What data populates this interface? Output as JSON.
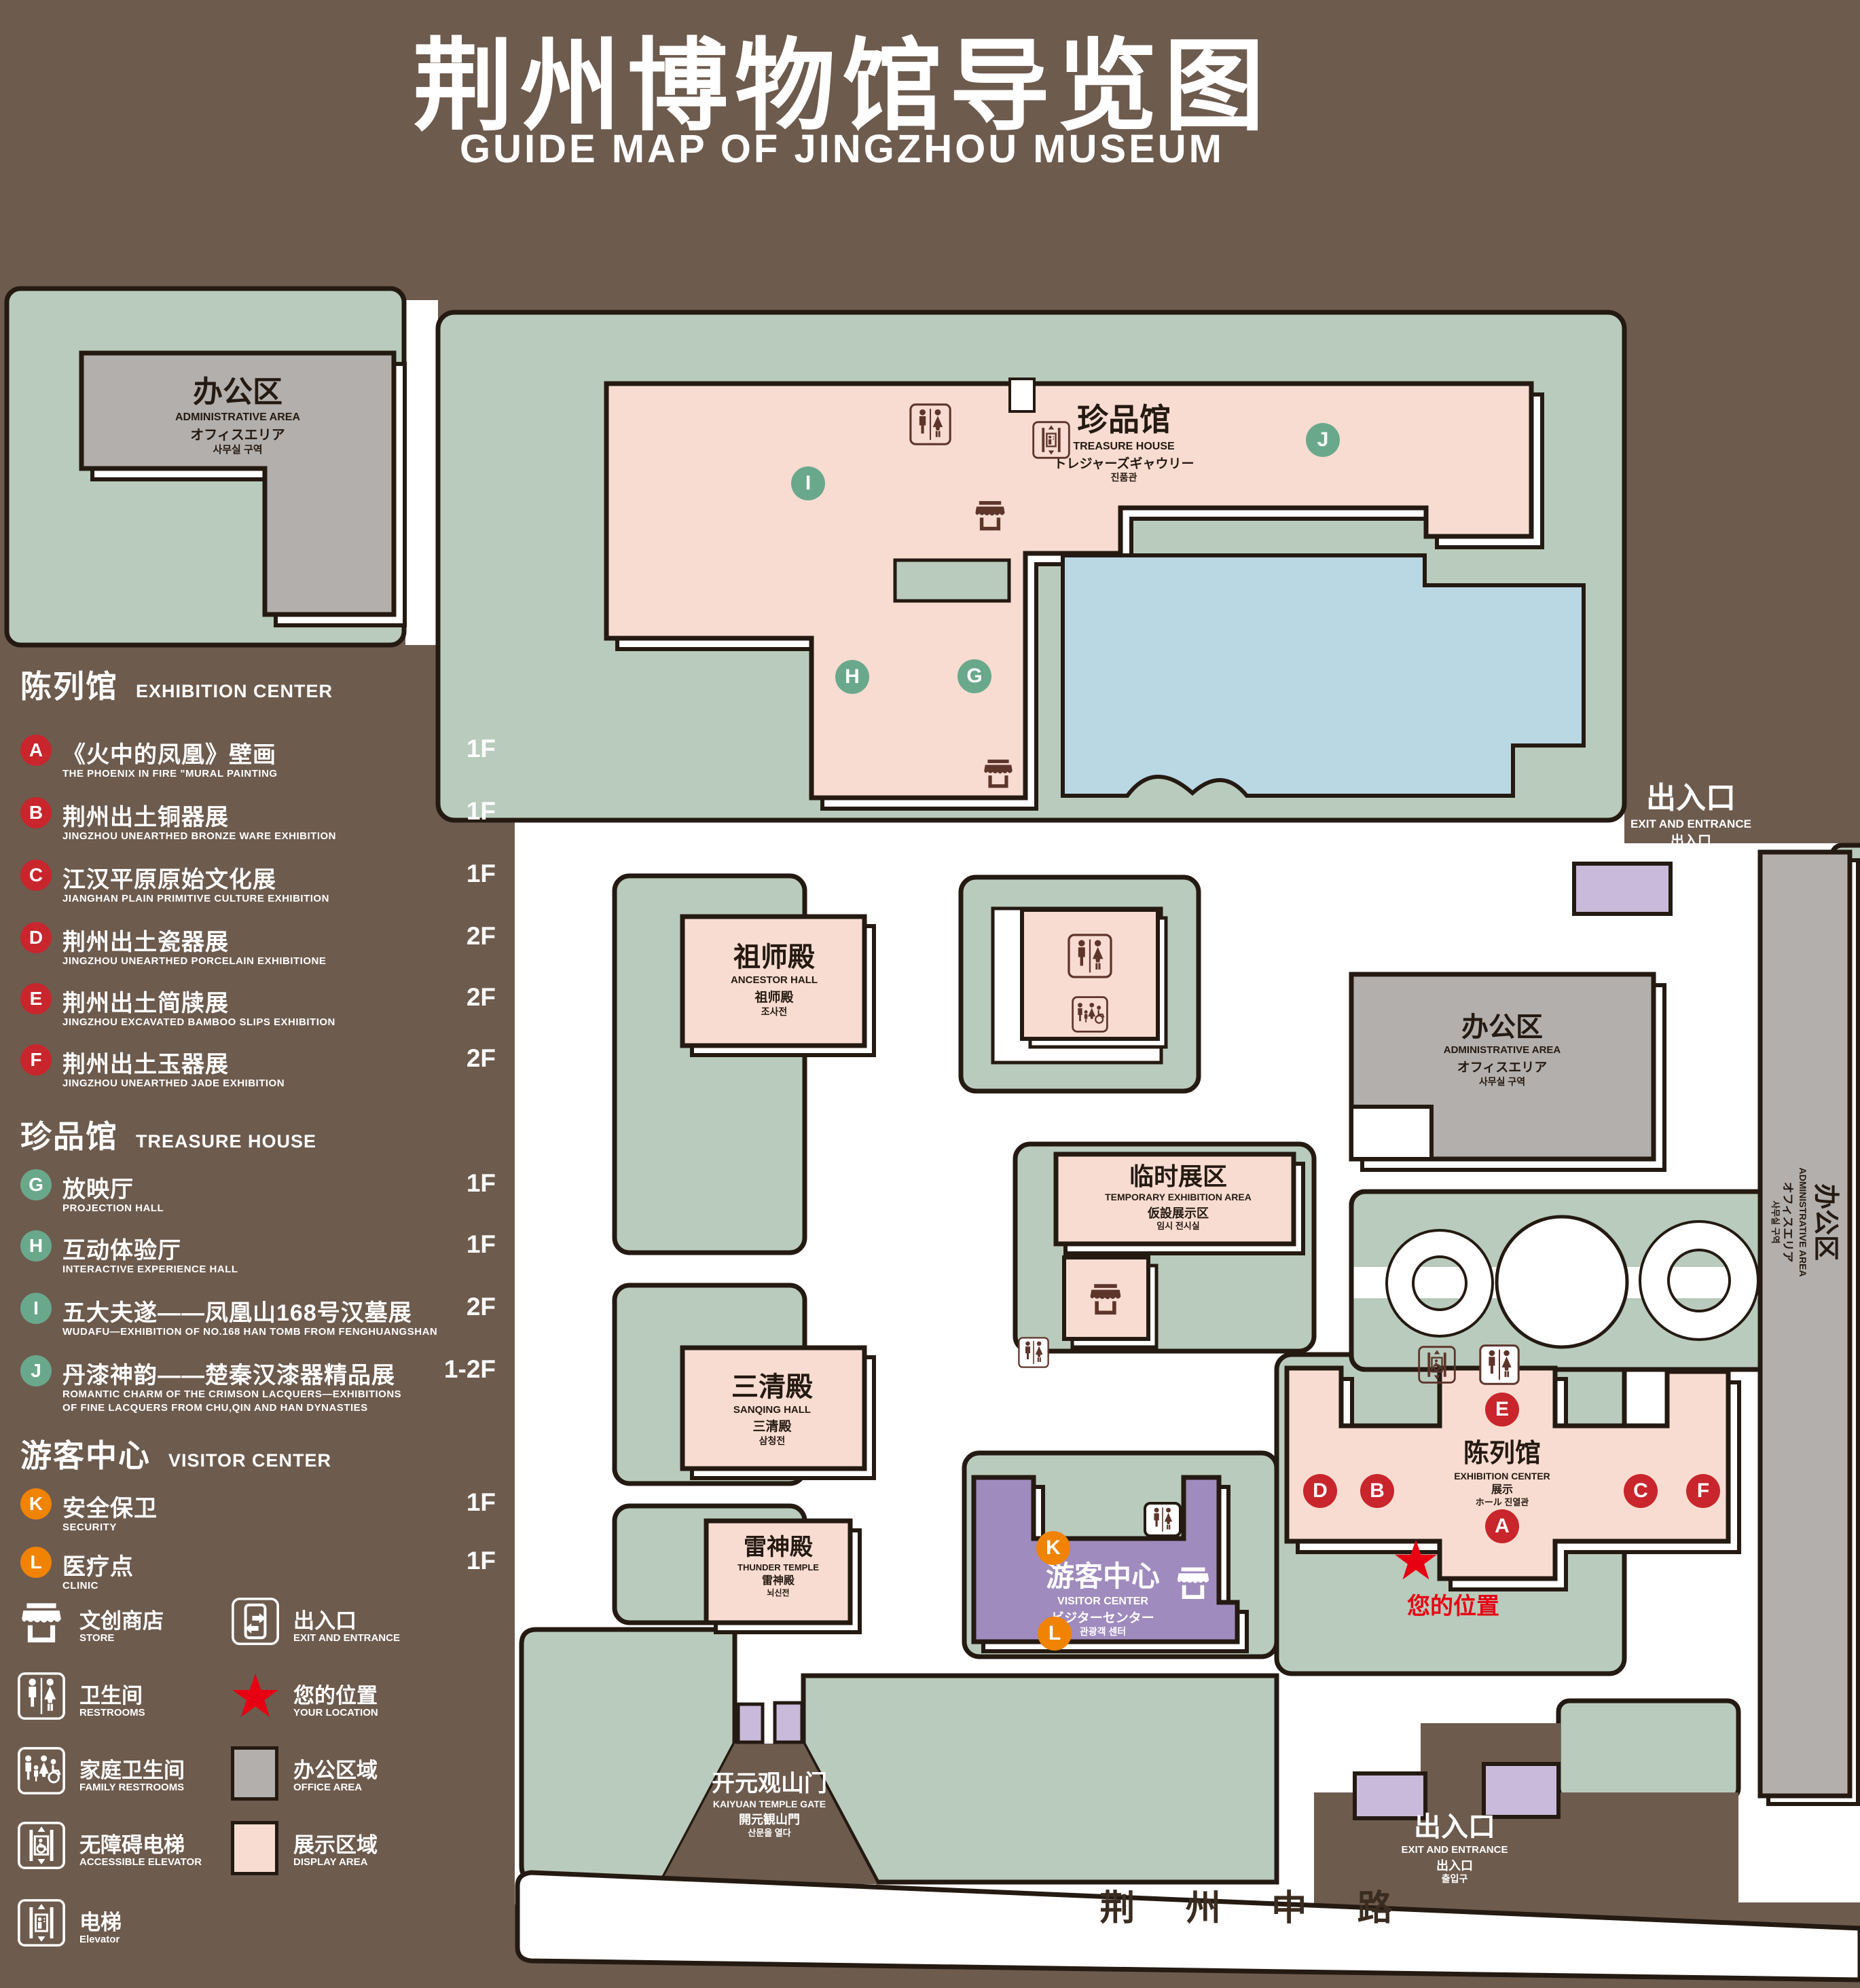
{
  "title": {
    "zh": "荆州博物馆导览图",
    "en": "GUIDE MAP OF JINGZHOU MUSEUM"
  },
  "legend": {
    "sections": [
      {
        "zh": "陈列馆",
        "en": "EXHIBITION CENTER",
        "items": [
          {
            "letter": "A",
            "zh": "《火中的凤凰》壁画",
            "en": "THE PHOENIX IN FIRE \"MURAL PAINTING",
            "floor": "1F"
          },
          {
            "letter": "B",
            "zh": "荆州出土铜器展",
            "en": "JINGZHOU UNEARTHED BRONZE WARE EXHIBITION",
            "floor": "1F"
          },
          {
            "letter": "C",
            "zh": "江汉平原原始文化展",
            "en": "JIANGHAN PLAIN PRIMITIVE CULTURE EXHIBITION",
            "floor": "1F"
          },
          {
            "letter": "D",
            "zh": "荆州出土瓷器展",
            "en": "JINGZHOU UNEARTHED PORCELAIN EXHIBITIONE",
            "floor": "2F"
          },
          {
            "letter": "E",
            "zh": "荆州出土简牍展",
            "en": "JINGZHOU EXCAVATED BAMBOO SLIPS EXHIBITION",
            "floor": "2F"
          },
          {
            "letter": "F",
            "zh": "荆州出土玉器展",
            "en": "JINGZHOU UNEARTHED JADE EXHIBITION",
            "floor": "2F"
          }
        ]
      },
      {
        "zh": "珍品馆",
        "en": "TREASURE HOUSE",
        "items": [
          {
            "letter": "G",
            "zh": "放映厅",
            "en": "PROJECTION HALL",
            "floor": "1F"
          },
          {
            "letter": "H",
            "zh": "互动体验厅",
            "en": "INTERACTIVE EXPERIENCE HALL",
            "floor": "1F"
          },
          {
            "letter": "I",
            "zh": "五大夫遂——凤凰山168号汉墓展",
            "en": "WUDAFU—EXHIBITION OF NO.168 HAN TOMB FROM FENGHUANGSHAN",
            "floor": "2F"
          },
          {
            "letter": "J",
            "zh": "丹漆神韵——楚秦汉漆器精品展",
            "en": "ROMANTIC CHARM OF THE CRIMSON LACQUERS—EXHIBITIONS",
            "en2": "OF FINE LACQUERS FROM CHU,QIN AND HAN DYNASTIES",
            "floor": "1-2F"
          }
        ]
      },
      {
        "zh": "游客中心",
        "en": "VISITOR CENTER",
        "items": [
          {
            "letter": "K",
            "zh": "安全保卫",
            "en": "SECURITY",
            "floor": "1F"
          },
          {
            "letter": "L",
            "zh": "医疗点",
            "en": "CLINIC",
            "floor": "1F"
          }
        ]
      }
    ],
    "symbols": [
      {
        "zh": "文创商店",
        "en": "STORE"
      },
      {
        "zh": "出入口",
        "en": "EXIT AND ENTRANCE"
      },
      {
        "zh": "卫生间",
        "en": "RESTROOMS"
      },
      {
        "zh": "您的位置",
        "en": "YOUR LOCATION"
      },
      {
        "zh": "家庭卫生间",
        "en": "FAMILY RESTROOMS"
      },
      {
        "zh": "办公区域",
        "en": "OFFICE AREA"
      },
      {
        "zh": "无障碍电梯",
        "en": "ACCESSIBLE ELEVATOR"
      },
      {
        "zh": "展示区域",
        "en": "DISPLAY AREA"
      },
      {
        "zh": "电梯",
        "en": "Elevator"
      }
    ]
  },
  "map": {
    "labels": {
      "admin_tl": {
        "zh": "办公区",
        "en": "ADMINISTRATIVE AREA",
        "ja": "オフィスエリア",
        "ko": "사무실 구역"
      },
      "admin_mid": {
        "zh": "办公区",
        "en": "ADMINISTRATIVE AREA",
        "ja": "オフィスエリア",
        "ko": "사무실 구역"
      },
      "admin_right": {
        "zh": "办公区",
        "en": "ADMINISTRATIVE AREA",
        "ja": "オフィスエリア",
        "ko": "사무실 구역"
      },
      "treasure": {
        "zh": "珍品馆",
        "en": "TREASURE HOUSE",
        "ja": "トレジャーズギャウリー",
        "ko": "진품관"
      },
      "ancestor": {
        "zh": "祖师殿",
        "en": "ANCESTOR HALL",
        "ja": "祖师殿",
        "ko": "조사전"
      },
      "temporary": {
        "zh": "临时展区",
        "en": "TEMPORARY EXHIBITION AREA",
        "ja": "仮設展示区",
        "ko": "임시 전시실"
      },
      "sanqing": {
        "zh": "三清殿",
        "en": "SANQING HALL",
        "ja": "三清殿",
        "ko": "삼청전"
      },
      "thunder": {
        "zh": "雷神殿",
        "en": "THUNDER TEMPLE",
        "ja": "雷神殿",
        "ko": "뇌신전"
      },
      "visitor": {
        "zh": "游客中心",
        "en": "VISITOR CENTER",
        "ja": "ビジターセンター",
        "ko": "관광객 센터"
      },
      "exhibition": {
        "zh": "陈列馆",
        "en": "EXHIBITION CENTER",
        "ja": "展示",
        "ko": "ホール 진열관"
      },
      "kaiyuan": {
        "zh": "开元观山门",
        "en": "KAIYUAN TEMPLE GATE",
        "ja": "開元観山門",
        "ko": "산문을 열다"
      },
      "exit_east": {
        "zh": "出入口",
        "en": "EXIT AND ENTRANCE",
        "ja": "出入口",
        "ko": "출입구"
      },
      "exit_south": {
        "zh": "出入口",
        "en": "EXIT AND ENTRANCE",
        "ja": "出入口",
        "ko": "출입구"
      },
      "your_location": "您的位置",
      "road": "荆 州 中 路"
    },
    "markers": [
      {
        "letter": "A"
      },
      {
        "letter": "B"
      },
      {
        "letter": "C"
      },
      {
        "letter": "D"
      },
      {
        "letter": "E"
      },
      {
        "letter": "F"
      },
      {
        "letter": "G"
      },
      {
        "letter": "H"
      },
      {
        "letter": "I"
      },
      {
        "letter": "J"
      },
      {
        "letter": "K"
      },
      {
        "letter": "L"
      }
    ]
  },
  "colors": {
    "background": "#6d5b4e",
    "courtyard_green": "#b9cbbc",
    "display_pink": "#f8dcd1",
    "office_gray": "#b3afac",
    "visitor_purple": "#9f8bbd",
    "gate_purple": "#c9b9da",
    "pond_blue": "#bad7e4",
    "outline_ink": "#241a12",
    "marker_red": "#c9252c",
    "marker_green": "#6aa88b",
    "marker_orange": "#f08300",
    "location_red": "#e60012"
  }
}
